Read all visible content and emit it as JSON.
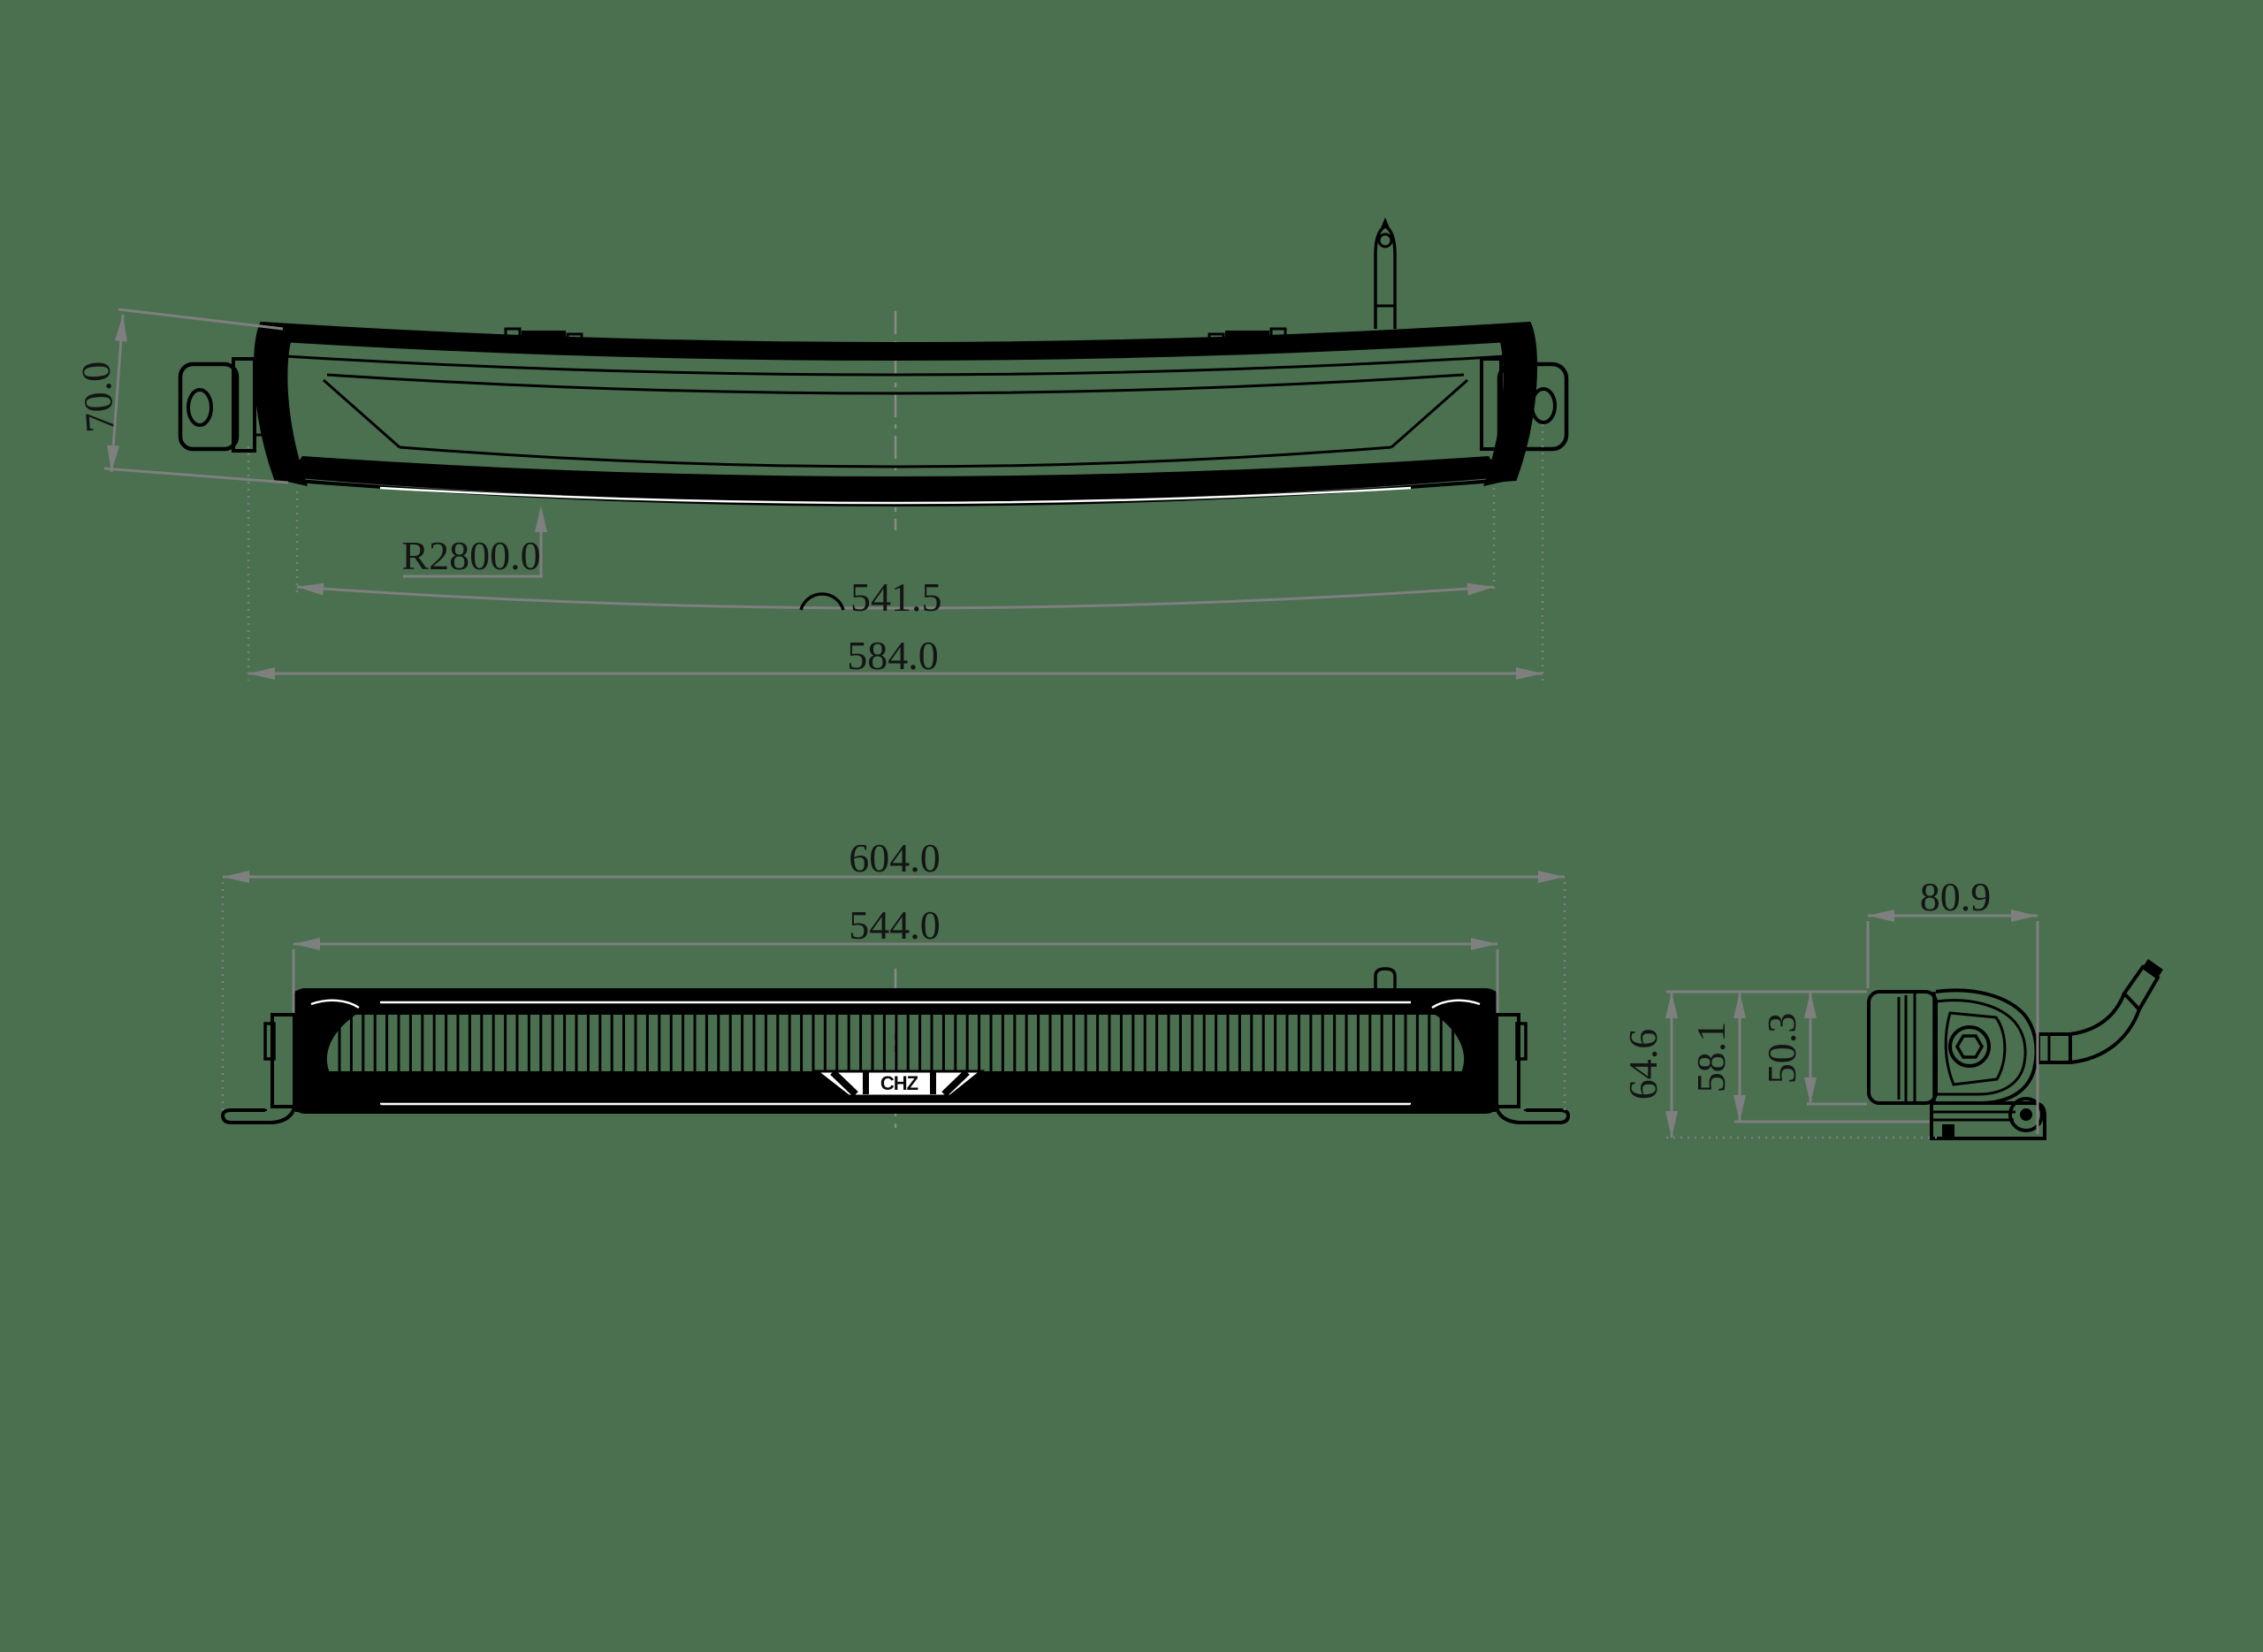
{
  "colors": {
    "background": "#4a7050",
    "ink": "#000000",
    "dim_gray": "#7f7f7f"
  },
  "views": {
    "top": {
      "dims": {
        "end_height": "70.0",
        "bend_radius": "R2800.0",
        "arc_length": "541.5",
        "hole_span": "584.0"
      }
    },
    "front": {
      "dims": {
        "overall_length": "604.0",
        "inner_span": "544.0"
      },
      "logo_text": "CHZ"
    },
    "side": {
      "dims": {
        "depth": "80.9",
        "overall_height": "64.6",
        "bracket_height": "58.1",
        "lens_height": "50.3"
      }
    }
  }
}
